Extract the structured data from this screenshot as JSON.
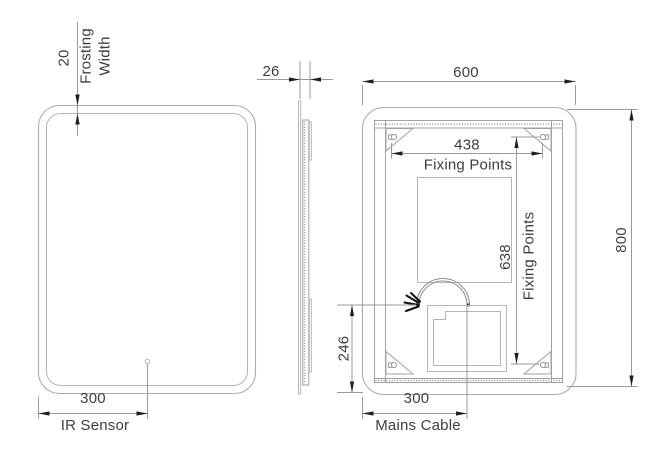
{
  "drawing_type": "mirror technical drawing, three orthographic views",
  "views": {
    "front": {
      "frosting_value": "20",
      "frosting_label_1": "Frosting",
      "frosting_label_2": "Width",
      "ir_value": "300",
      "ir_label": "IR Sensor"
    },
    "side": {
      "thickness_value": "26"
    },
    "back": {
      "width_value": "600",
      "height_value": "800",
      "fixing_width_value": "438",
      "fixing_width_label": "Fixing Points",
      "fixing_height_value": "638",
      "fixing_height_label": "Fixing Points",
      "cable_offset_value": "246",
      "mains_value": "300",
      "mains_label": "Mains Cable"
    }
  },
  "colors": {
    "background": "#ffffff",
    "outline_gray": "#a9adb0",
    "dimension_gray": "#979b9e",
    "text_dark": "#3c3f42",
    "arrow_black": "#1f1f1f"
  }
}
